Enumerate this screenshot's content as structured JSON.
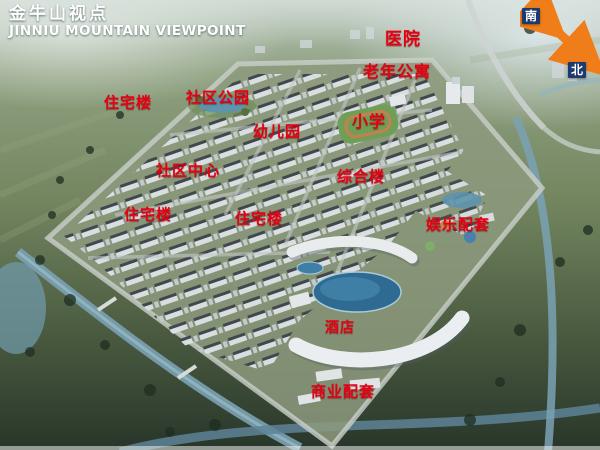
{
  "title": {
    "zh": "金牛山视点",
    "en": "JINNIU MOUNTAIN VIEWPOINT"
  },
  "compass": {
    "south_label": "南",
    "north_label": "北"
  },
  "map_labels": [
    {
      "id": "hospital",
      "text": "医院",
      "x": 403,
      "y": 37,
      "size": 17
    },
    {
      "id": "senior-apartments",
      "text": "老年公寓",
      "x": 397,
      "y": 70,
      "size": 16
    },
    {
      "id": "residential-1",
      "text": "住宅楼",
      "x": 128,
      "y": 102,
      "size": 15
    },
    {
      "id": "community-park",
      "text": "社区公园",
      "x": 218,
      "y": 97,
      "size": 15
    },
    {
      "id": "kindergarten",
      "text": "幼儿园",
      "x": 277,
      "y": 131,
      "size": 15
    },
    {
      "id": "primary-school",
      "text": "小学",
      "x": 369,
      "y": 120,
      "size": 16
    },
    {
      "id": "community-center",
      "text": "社区中心",
      "x": 188,
      "y": 170,
      "size": 15
    },
    {
      "id": "comprehensive-building",
      "text": "综合楼",
      "x": 361,
      "y": 176,
      "size": 15
    },
    {
      "id": "residential-2",
      "text": "住宅楼",
      "x": 148,
      "y": 214,
      "size": 15
    },
    {
      "id": "residential-3",
      "text": "住宅楼",
      "x": 259,
      "y": 218,
      "size": 15
    },
    {
      "id": "entertainment-facilities",
      "text": "娱乐配套",
      "x": 458,
      "y": 224,
      "size": 15
    },
    {
      "id": "hotel",
      "text": "酒店",
      "x": 340,
      "y": 327,
      "size": 14
    },
    {
      "id": "commercial-facilities",
      "text": "商业配套",
      "x": 343,
      "y": 391,
      "size": 15
    }
  ],
  "colors": {
    "label_red": "#e60012",
    "title_white": "#ffffff",
    "arrow_orange": "#ef7d1a"
  }
}
